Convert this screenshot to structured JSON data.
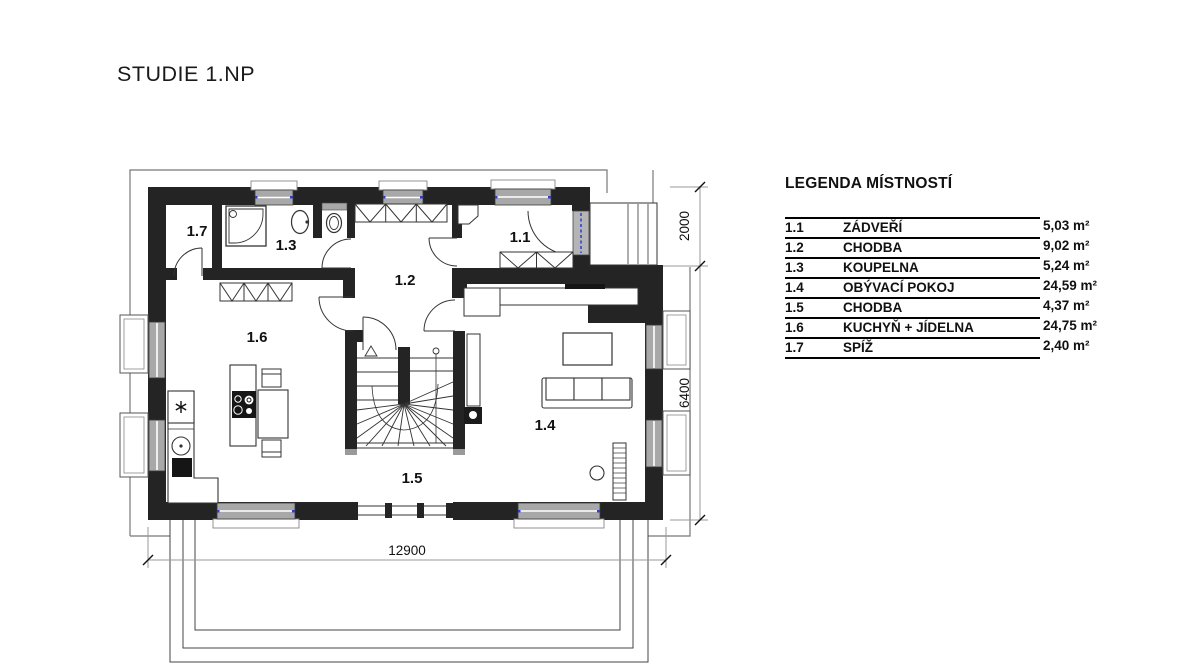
{
  "title": "STUDIE 1.NP",
  "legend": {
    "title": "LEGENDA MÍSTNOSTÍ",
    "rows": [
      {
        "num": "1.1",
        "name": "ZÁDVEŘÍ",
        "area": "5,03 m²"
      },
      {
        "num": "1.2",
        "name": "CHODBA",
        "area": "9,02 m²"
      },
      {
        "num": "1.3",
        "name": "KOUPELNA",
        "area": "5,24 m²"
      },
      {
        "num": "1.4",
        "name": "OBÝVACÍ POKOJ",
        "area": "24,59 m²"
      },
      {
        "num": "1.5",
        "name": "CHODBA",
        "area": "4,37 m²"
      },
      {
        "num": "1.6",
        "name": "KUCHYŇ + JÍDELNA",
        "area": "24,75 m²"
      },
      {
        "num": "1.7",
        "name": "SPÍŽ",
        "area": "2,40 m²"
      }
    ]
  },
  "plan": {
    "name": "floor-plan-1np",
    "room_labels": {
      "r11": "1.1",
      "r12": "1.2",
      "r13": "1.3",
      "r14": "1.4",
      "r15": "1.5",
      "r16": "1.6",
      "r17": "1.7"
    },
    "dimensions": {
      "bottom": "12900",
      "right_upper": "2000",
      "right_lower": "6400"
    },
    "icons": {
      "freezer": "snowflake-icon",
      "stairs_direction": "up-arrow-icon"
    },
    "colors": {
      "wall": "#242424",
      "window": "#a8a8a8",
      "door_accent": "#2b3bd6",
      "dimension_line": "#999999"
    }
  }
}
